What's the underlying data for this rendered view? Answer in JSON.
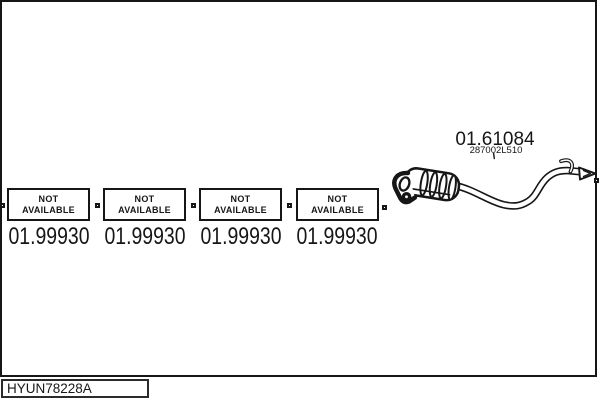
{
  "colors": {
    "line": "#161616",
    "background": "#ffffff"
  },
  "parts": {
    "placeholders": [
      {
        "line1": "NOT",
        "line2": "AVAILABLE",
        "part_number": "01.99930"
      },
      {
        "line1": "NOT",
        "line2": "AVAILABLE",
        "part_number": "01.99930"
      },
      {
        "line1": "NOT",
        "line2": "AVAILABLE",
        "part_number": "01.99930"
      },
      {
        "line1": "NOT",
        "line2": "AVAILABLE",
        "part_number": "01.99930"
      }
    ],
    "muffler": {
      "part_number": "01.61084",
      "oem_number": "287002L510"
    }
  },
  "footer": {
    "diagram_code": "HYUN78228A"
  }
}
